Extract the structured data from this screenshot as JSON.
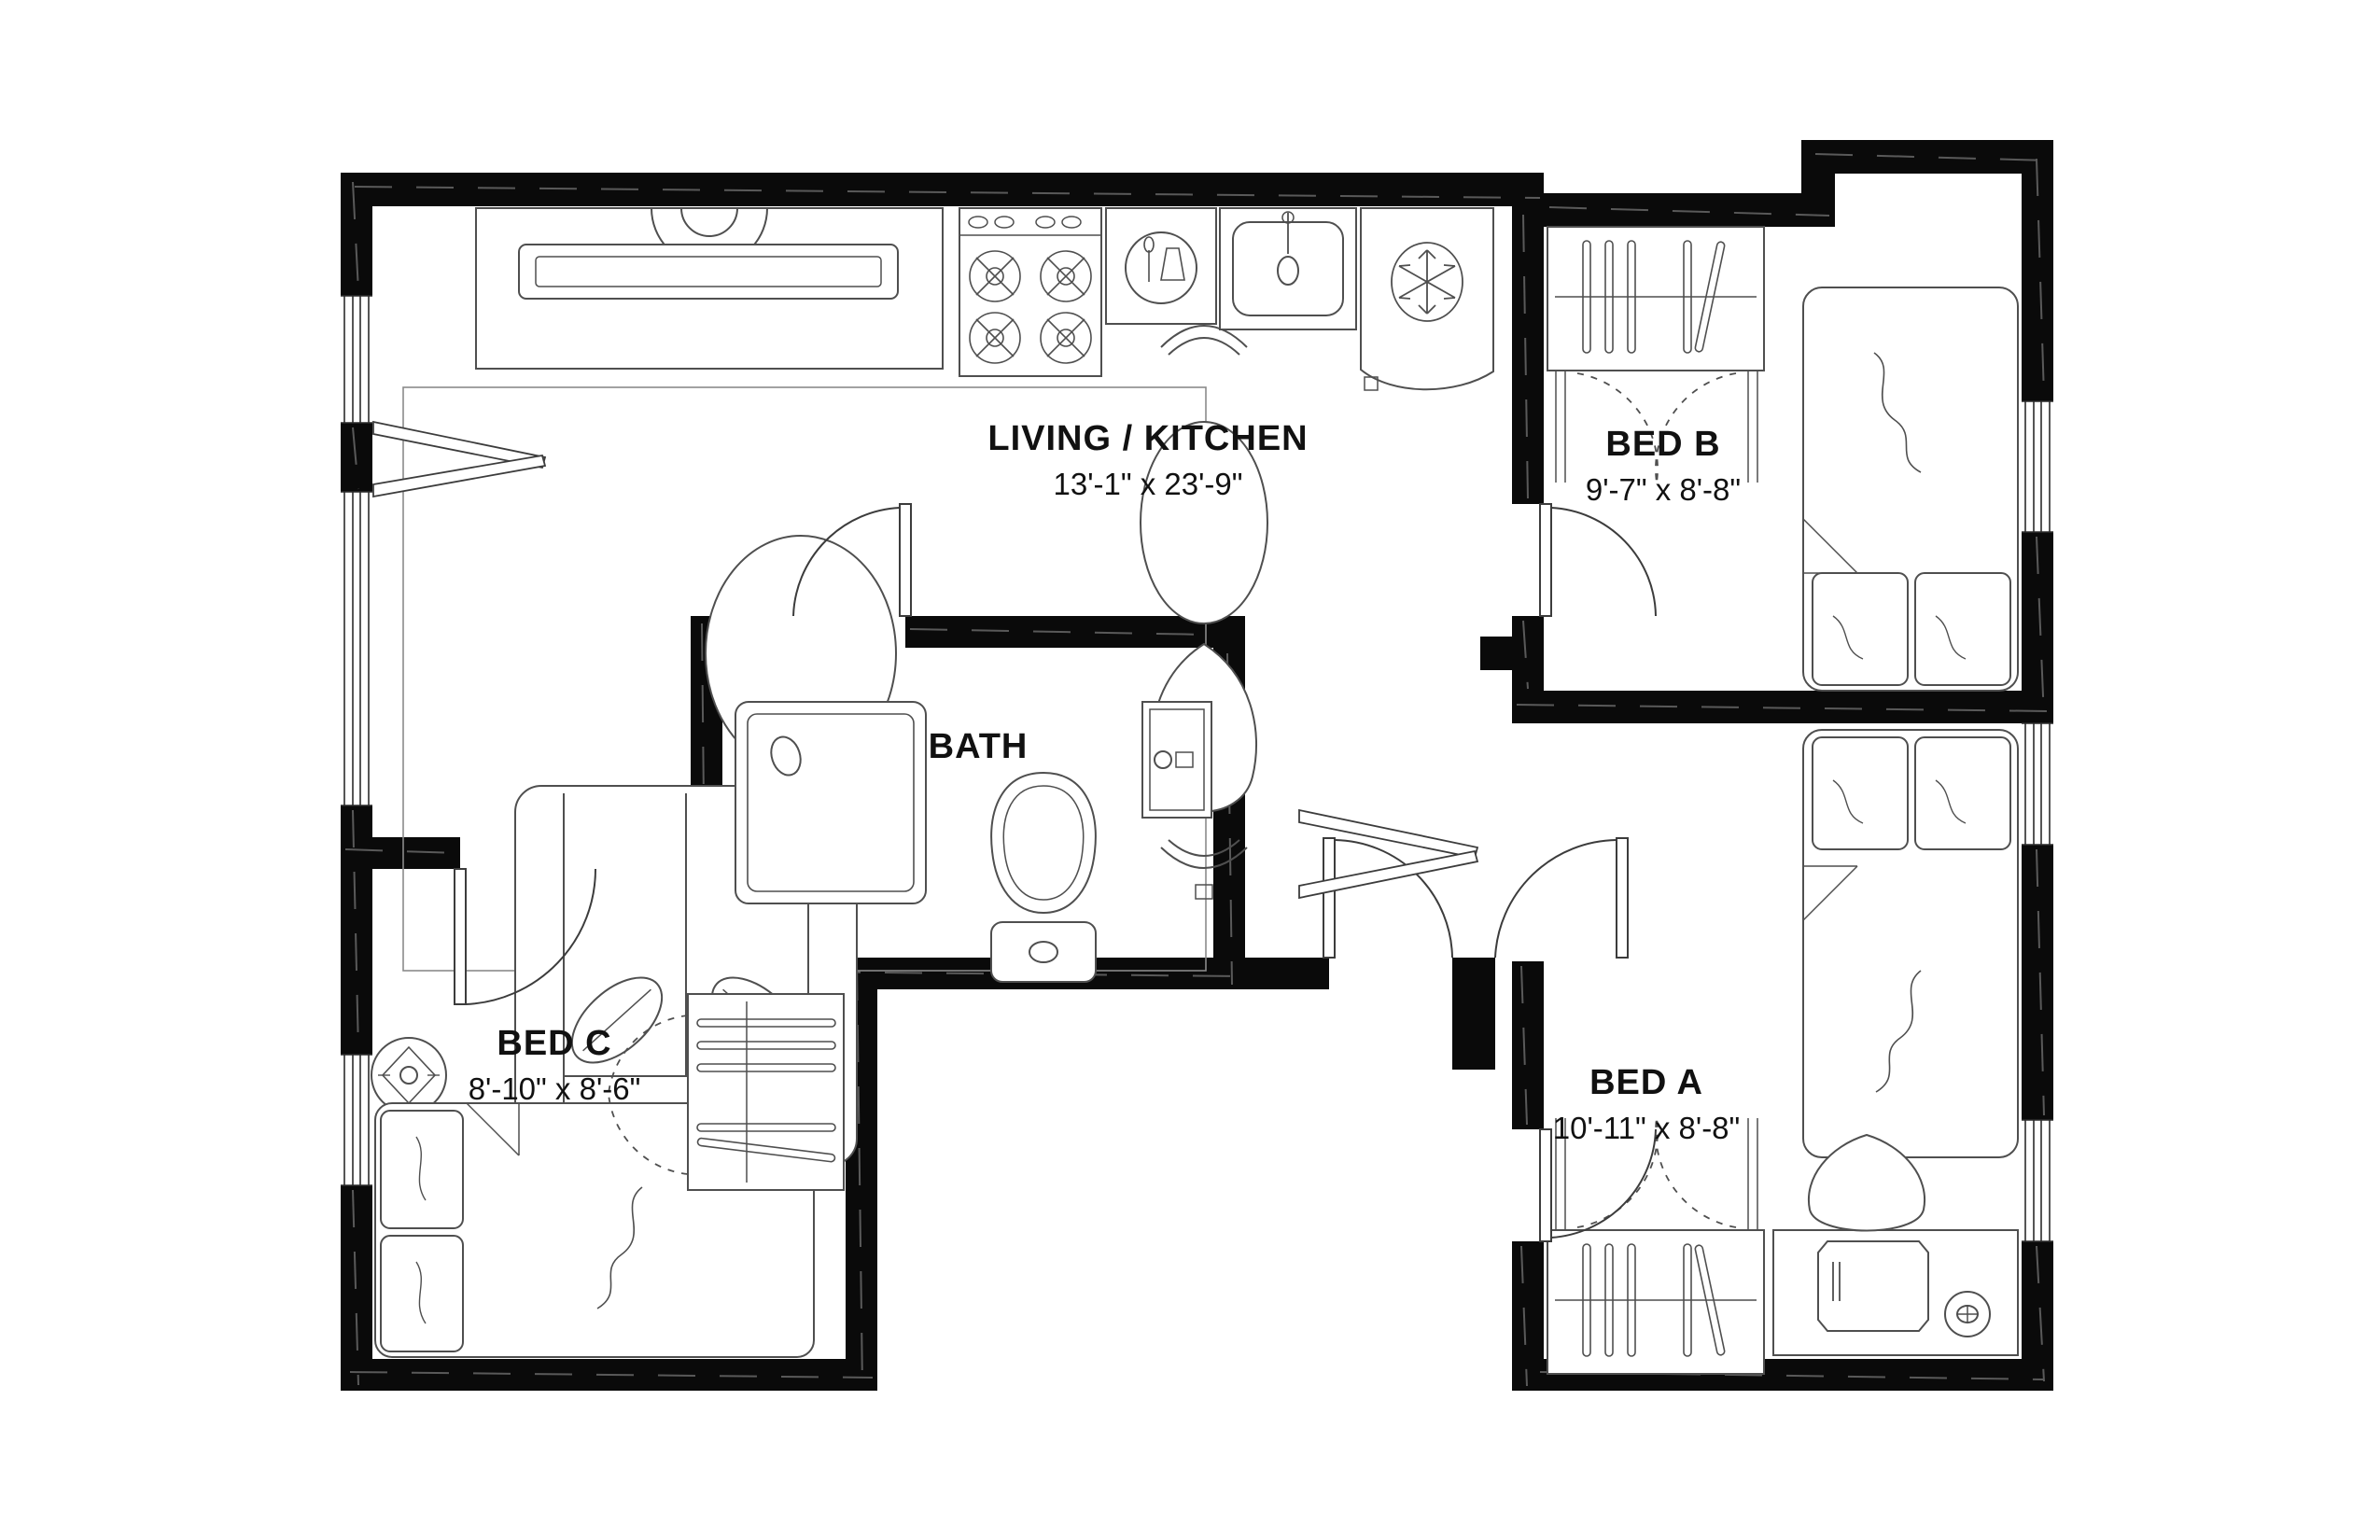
{
  "rooms": {
    "living_kitchen": {
      "label": "LIVING / KITCHEN",
      "dimensions": "13'-1\" x 23'-9\""
    },
    "bed_b": {
      "label": "BED B",
      "dimensions": "9'-7\" x 8'-8\""
    },
    "bed_a": {
      "label": "BED A",
      "dimensions": "10'-11\" x 8'-8\""
    },
    "bed_c": {
      "label": "BED C",
      "dimensions": "8'-10\" x 8'-6\""
    },
    "bath": {
      "label": "BATH"
    }
  },
  "colors": {
    "wall": "#0a0a0a",
    "background": "#ffffff",
    "furniture_outline": "#4f4f4f",
    "label_text": "#111111"
  },
  "fixtures": {
    "living_kitchen": [
      "tv-console",
      "tv",
      "rug",
      "coffee-table",
      "sofa",
      "throw-pillows",
      "floor-vases",
      "stove",
      "dishwasher",
      "sink",
      "refrigerator"
    ],
    "bed_b": [
      "closet-with-hangers",
      "bifold-doors",
      "bed-with-pillows"
    ],
    "bed_a": [
      "bed-with-pillows",
      "closet-with-hangers",
      "bifold-doors",
      "desk",
      "desk-chair",
      "laptop",
      "mug"
    ],
    "bed_c": [
      "bed-with-pillows",
      "ceiling-fan",
      "closet-with-shelves",
      "bifold-doors"
    ],
    "bath": [
      "shower",
      "toilet",
      "vanity-sink"
    ]
  }
}
